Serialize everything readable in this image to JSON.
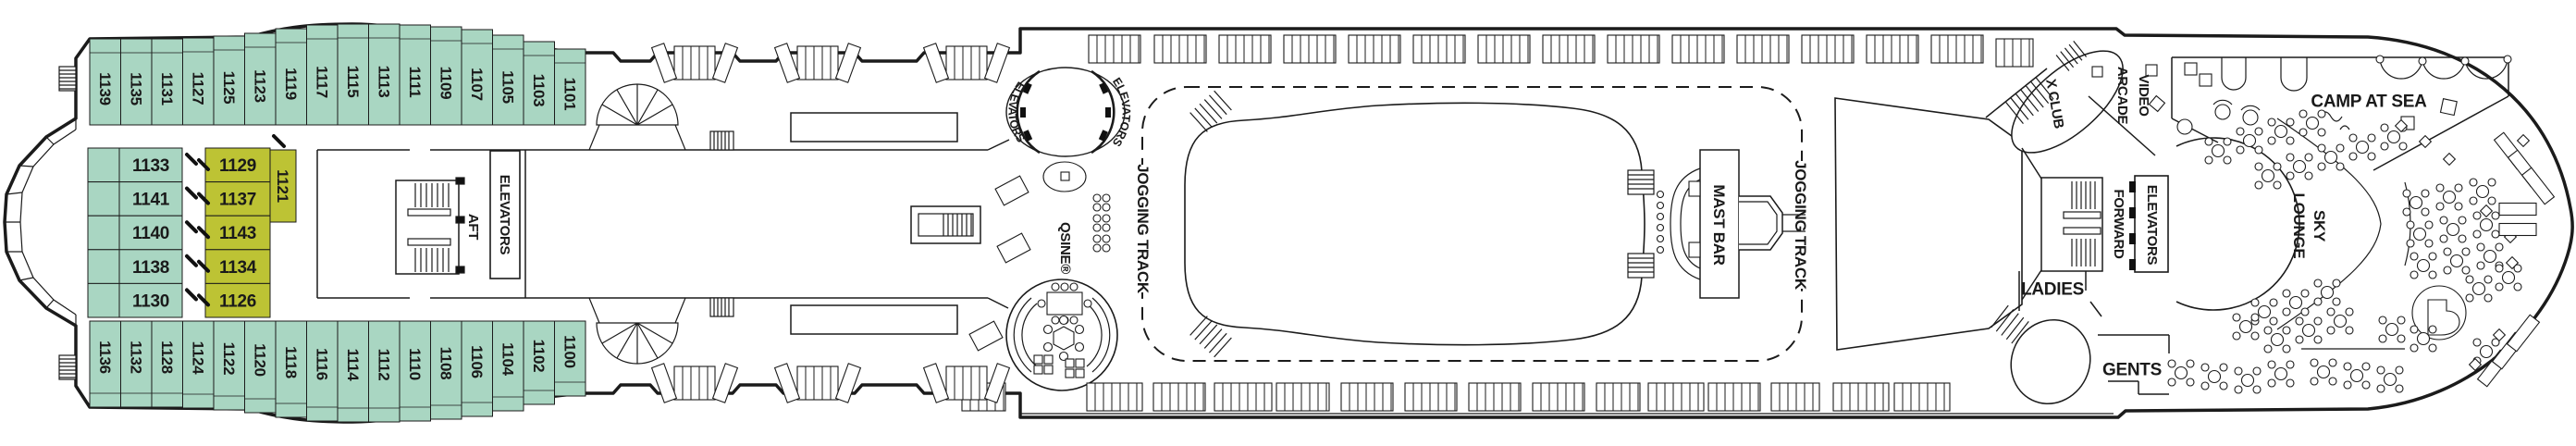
{
  "colors": {
    "cabin_green": "#a9d6c2",
    "cabin_yellow": "#bdc334",
    "line": "#1b1b1b",
    "cabin_text": "#10291f"
  },
  "cabins": {
    "top_row": [
      "1139",
      "1135",
      "1131",
      "1127",
      "1125",
      "1123",
      "1119",
      "1117",
      "1115",
      "1113",
      "1111",
      "1109",
      "1107",
      "1105",
      "1103",
      "1101"
    ],
    "bottom_row": [
      "1136",
      "1132",
      "1128",
      "1124",
      "1122",
      "1120",
      "1118",
      "1116",
      "1114",
      "1112",
      "1110",
      "1108",
      "1106",
      "1104",
      "1102",
      "1100"
    ],
    "mid_green": [
      "1133",
      "1141",
      "1140",
      "1138",
      "1130"
    ],
    "mid_yellow": [
      "1129",
      "1137",
      "1143",
      "1134",
      "1126"
    ],
    "mid_yellow_vertical": "1121"
  },
  "labels": {
    "aft": "AFT",
    "forward": "FORWARD",
    "elevators_aft": "ELEVATORS",
    "elevators_mid_left": "ELEVATORS",
    "elevators_mid_right": "ELEVATORS",
    "elevators_forward": "ELEVATORS",
    "qsine": "QSINE®",
    "jogging_track_left": "JOGGING TRACK",
    "jogging_track_right": "JOGGING TRACK",
    "mast_bar": "MAST BAR",
    "x_club": "X CLUB",
    "video_arcade_lines": [
      "VIDEO",
      "ARCADE"
    ],
    "camp_at_sea": "CAMP AT SEA",
    "sky_lounge_lines": [
      "SKY",
      "LOUNGE"
    ],
    "ladies": "LADIES",
    "gents": "GENTS"
  }
}
